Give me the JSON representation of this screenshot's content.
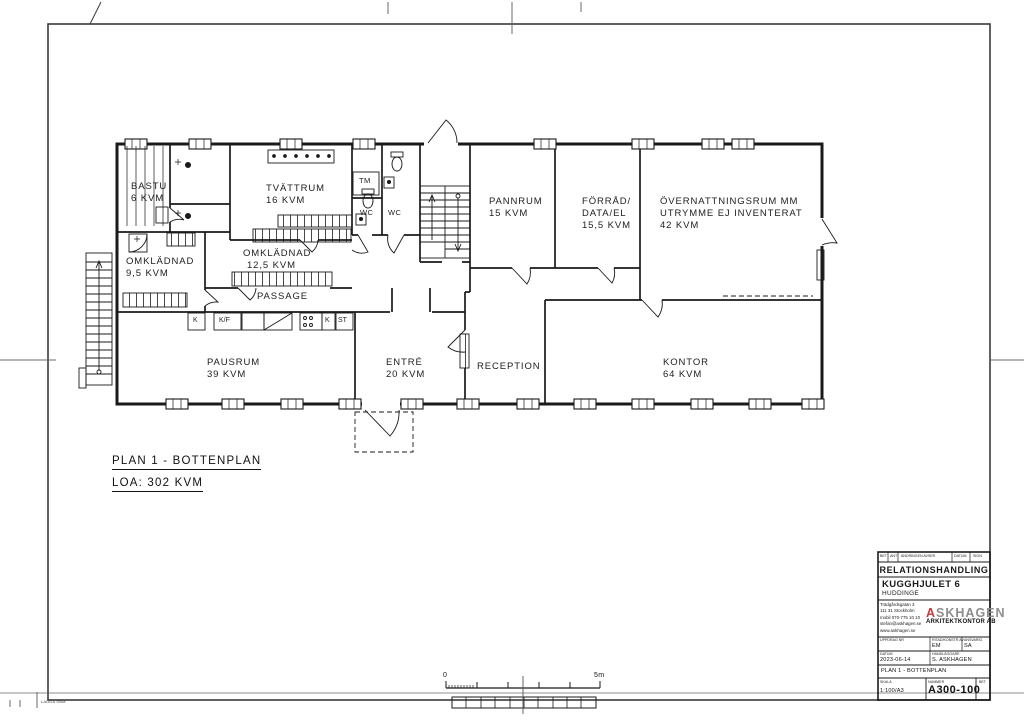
{
  "sheet": {
    "plan_title": "PLAN 1 - BOTTENPLAN",
    "plan_area": "LOA: 302 KVM",
    "stamp": "LADDA SBM"
  },
  "rooms": {
    "bastu": {
      "name": "BASTU",
      "area": "6 KVM"
    },
    "tvattrum": {
      "name": "TVÄTTRUM",
      "area": "16 KVM"
    },
    "omklad95": {
      "name": "OMKLÄDNAD",
      "area": "9,5 KVM"
    },
    "omklad125": {
      "name": "OMKLÄDNAD",
      "area": "12,5 KVM"
    },
    "passage": {
      "name": "PASSAGE"
    },
    "pannrum": {
      "name": "PANNRUM",
      "area": "15 KVM"
    },
    "forrad": {
      "name": "FÖRRÅD/",
      "line2": "DATA/EL",
      "area": "15,5 KVM"
    },
    "overnattning": {
      "name": "ÖVERNATTNINGSRUM MM",
      "line2": "UTRYMME EJ INVENTERAT",
      "area": "42 KVM"
    },
    "pausrum": {
      "name": "PAUSRUM",
      "area": "39 KVM"
    },
    "entre": {
      "name": "ENTRÉ",
      "area": "20 KVM"
    },
    "reception": {
      "name": "RECEPTION"
    },
    "kontor": {
      "name": "KONTOR",
      "area": "64 KVM"
    }
  },
  "fixtures": {
    "tm": "TM",
    "wc_left": "WC",
    "wc_right": "WC",
    "kitchen": {
      "k1": "K",
      "kf": "K/F",
      "k2": "K",
      "st": "ST"
    }
  },
  "scalebar": {
    "start": "0",
    "end": "5m"
  },
  "titleblock": {
    "header": {
      "bet": "BET",
      "ant": "ANT",
      "change": "ÄNDRINGEN AVSER",
      "datum": "DATUM",
      "sign": "SIGN"
    },
    "status": "RELATIONSHANDLING",
    "project": "KUGGHJULET 6",
    "municipality": "HUDDINGE",
    "address": {
      "l1": "Trädgårdsgatan 3",
      "l2": "111 31 Stockholm",
      "l3": "mobil 070-775 10 10",
      "l4": "stefan@askhagen.se",
      "l5": "www.askhagen.se"
    },
    "logo": {
      "a": "A",
      "rest": "SKHAGEN",
      "sub": "ARKITEKTKONTOR AB"
    },
    "fields": {
      "uppdrag_label": "UPPDRAG NR",
      "ritad_label": "RITAD/KONSTR AV",
      "ritad": "EM",
      "ansvarig_label": "ANSVARIG",
      "ansvarig": "SA",
      "datum_label": "DATUM",
      "datum": "2023-06-14",
      "handl_label": "HANDLÄGGARE",
      "handl": "S. ASKHAGEN"
    },
    "content": "PLAN 1 - BOTTENPLAN",
    "skala_label": "SKALA",
    "skala": "1:100/A3",
    "nummer_label": "NUMMER",
    "nummer": "A300-100",
    "bet_label": "BET"
  },
  "colors": {
    "line": "#1a1a1a",
    "logo_red": "#c43b3b"
  }
}
